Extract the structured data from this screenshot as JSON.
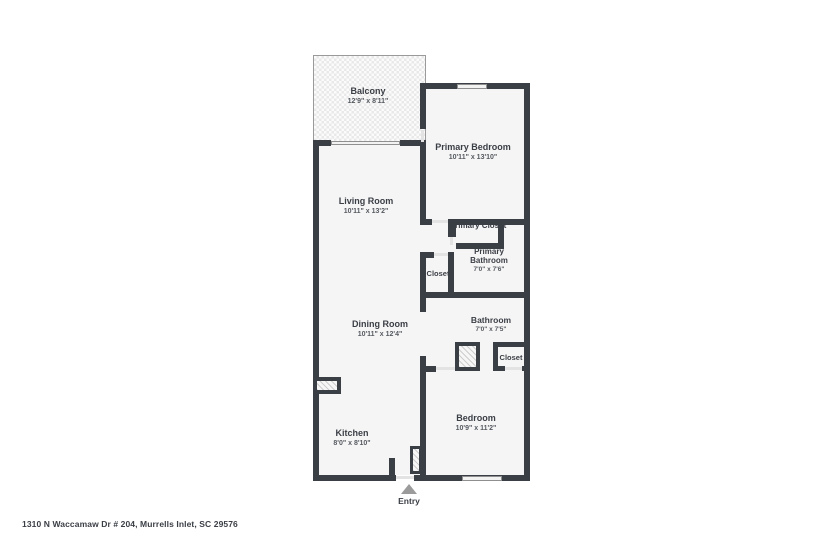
{
  "floor_plan": {
    "address": "1310 N Waccamaw Dr # 204, Murrells Inlet, SC 29576",
    "entry": {
      "label": "Entry"
    },
    "colors": {
      "wall": "#3a3e45",
      "room_fill": "#f5f5f5",
      "text": "#3a3e45",
      "window": "#f2f2f2",
      "entry_arrow": "#9b9b9b"
    },
    "rooms": {
      "balcony": {
        "name": "Balcony",
        "dims": "12'9\" x 8'11\""
      },
      "primary_bedroom": {
        "name": "Primary Bedroom",
        "dims": "10'11\" x 13'10\""
      },
      "living_room": {
        "name": "Living Room",
        "dims": "10'11\" x 13'2\""
      },
      "primary_closet": {
        "name": "Primary Closet"
      },
      "primary_bathroom": {
        "name": "Primary Bathroom",
        "dims": "7'0\" x 7'6\""
      },
      "hall_closet": {
        "name": "Closet"
      },
      "dining_room": {
        "name": "Dining Room",
        "dims": "10'11\" x 12'4\""
      },
      "bathroom": {
        "name": "Bathroom",
        "dims": "7'0\" x 7'5\""
      },
      "bedroom_closet": {
        "name": "Closet"
      },
      "bedroom": {
        "name": "Bedroom",
        "dims": "10'9\" x 11'2\""
      },
      "kitchen": {
        "name": "Kitchen",
        "dims": "8'0\" x 8'10\""
      }
    }
  }
}
